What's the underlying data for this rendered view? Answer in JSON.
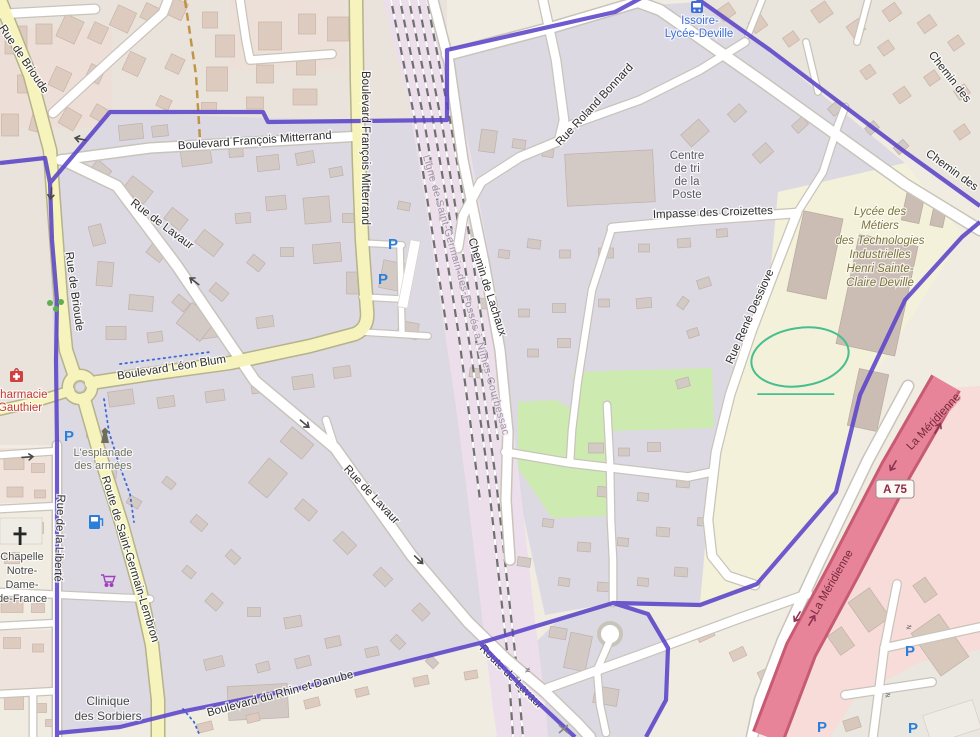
{
  "map_labels": {
    "rue_de_brioude": "Rue de Brioude",
    "boulevard_francois_mitterrand": "Boulevard François Mitterrand",
    "rue_de_lavaur": "Rue de Lavaur",
    "route_de_lavaur": "Route de Lavaur",
    "boulevard_leon_blum": "Boulevard Léon Blum",
    "route_de_saint_germain_lembron": "Route de Saint-Germain-Lembron",
    "rue_de_la_liberte": "Rue de la Liberté",
    "boulevard_du_rhin_et_danube": "Boulevard du Rhin et Danube",
    "chemin_de_lachaux": "Chemin de Lachaux",
    "ligne_ferroviaire": "Ligne de Saint-Germain-des-Fossés à Nîmes-Courbessac",
    "rue_roland_bonnard": "Rue Roland Bonnard",
    "impasse_des_croizettes": "Impasse des Croizettes",
    "rue_rene_dessiove": "Rue René Dessiove",
    "chemin_des": "Chemin des",
    "la_meridienne": "La Méridienne",
    "a75_ref": "A 75"
  },
  "places": {
    "transit_stop": [
      "Issoire-",
      "Lycée-Deville"
    ],
    "pharmacie": [
      "Pharmacie",
      "Gauthier"
    ],
    "esplanade": [
      "L'esplanade",
      "des armées"
    ],
    "chapelle": [
      "Chapelle",
      "Notre-",
      "Dame-",
      "de-France"
    ],
    "clinique": [
      "Clinique",
      "des Sorbiers"
    ],
    "centre_tri": [
      "Centre",
      "de tri",
      "de la",
      "Poste"
    ],
    "lycee": [
      "Lycée des",
      "Métiers",
      "des Technologies",
      "Industrielles",
      "Henri Sainte-",
      "Claire Deville"
    ]
  },
  "icons": {
    "parking": "P",
    "gate": "≠"
  },
  "colors": {
    "boundary_purple": "#5b44c8",
    "admin_boundary_orange": "#b8872d",
    "motorway_fill": "#e8849a",
    "motorway_casing": "#c75b73",
    "secondary_road": "#f6f4bc",
    "residential_zone": "#dcd9e3",
    "outer_urban_zone": "#eae3dc",
    "industrial_pink_zone": "#f8dcd9",
    "school_zone": "#f4f1da",
    "railway_zone": "#ecdeea",
    "green_area": "#cdebb0",
    "sports_track_green": "#46be8f",
    "transit_blue": "#3d6fd7",
    "parking_blue": "#2a7fdb",
    "poi_red": "#c43c35",
    "school_text": "#7d7536",
    "motorway_text": "#73283f"
  }
}
